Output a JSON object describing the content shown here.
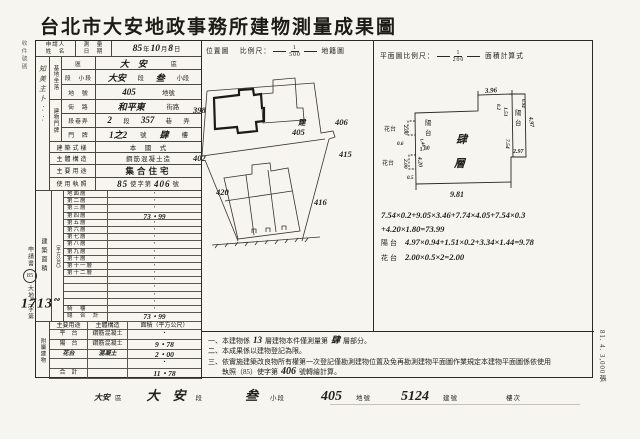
{
  "title": "台北市大安地政事務所建物測量成果圖",
  "margins": {
    "receipt": "收件號碼",
    "stamp_title": "申請書",
    "stamp_year": "85",
    "stamp_doc": "大地二字第",
    "stamp_no": "1713",
    "print_info": "81. 4. 3,000張"
  },
  "header": {
    "applicant1": "申請人",
    "applicant2": "姓　名",
    "hw_marks": "知美主卜︰︰",
    "date_label1": "測　量",
    "date_label2": "日　期",
    "date_y": "85",
    "date_y_u": "年",
    "date_m": "10",
    "date_m_u": "月",
    "date_d": "8",
    "date_d_u": "日",
    "loc_label": "位置圖",
    "loc_scale": "比例尺：",
    "loc_num": "1",
    "loc_den": "500",
    "loc_suffix": "地籍圖",
    "plan_scale": "平面圖比例尺：",
    "plan_num": "1",
    "plan_den": "200",
    "plan_suffix": "面積計算式"
  },
  "site": {
    "group": "基地坐落",
    "r1l": "區",
    "r1v": "大　安",
    "r1u": "區",
    "r2l": "段　小段",
    "r2v1": "大安",
    "r2u1": "段",
    "r2v2": "叁",
    "r2u2": "小段",
    "r3l": "地　號",
    "r3v": "405",
    "r3u": "地號"
  },
  "plate": {
    "group": "建物門牌",
    "r1l": "街　路",
    "r1v": "和平東",
    "r1u": "街路",
    "r2l": "段巷弄",
    "r2v1": "2",
    "r2u1": "段",
    "r2v2": "357",
    "r2u2": "巷",
    "r2u3": "弄",
    "r3l": "門　牌",
    "r3v": "1之2",
    "r3u1": "號",
    "r3v2": "肆",
    "r3u2": "樓"
  },
  "info": {
    "style_l": "建築式樣",
    "style_v": "本　國　式",
    "struct_l": "主體構造",
    "struct_v": "鋼筋混凝土造",
    "use_l": "主要用途",
    "use_v": "集合住宅",
    "lic_l": "使用執照",
    "lic_v1": "85",
    "lic_m": "使字第",
    "lic_v2": "406",
    "lic_u": "號"
  },
  "floors": {
    "group": "建築面積",
    "unit": "（平方公尺）",
    "rows": [
      [
        "地面層",
        "・"
      ],
      [
        "第二層",
        "・"
      ],
      [
        "第三層",
        "・"
      ],
      [
        "第四層",
        "73・99"
      ],
      [
        "第五層",
        "・"
      ],
      [
        "第六層",
        "・"
      ],
      [
        "第七層",
        "・"
      ],
      [
        "第八層",
        "・"
      ],
      [
        "第九層",
        "・"
      ],
      [
        "第十層",
        "・"
      ],
      [
        "第十一層",
        "・"
      ],
      [
        "第十二層",
        "・"
      ],
      [
        "",
        "・"
      ],
      [
        "",
        "・"
      ],
      [
        "",
        "・"
      ],
      [
        "",
        "・"
      ],
      [
        "騎　樓",
        "・"
      ],
      [
        "總　合　計",
        "73・99"
      ]
    ]
  },
  "attached": {
    "group": "附屬建物",
    "h1": "主要用途",
    "h2": "主體構造",
    "h3": "面積（平方公尺）",
    "rows": [
      [
        "平　台",
        "鋼筋混凝土",
        "・"
      ],
      [
        "陽　台",
        "鋼筋混凝土",
        "9・78"
      ],
      [
        "花台",
        "混凝土",
        "2・00"
      ],
      [
        "",
        "",
        "・"
      ],
      [
        "合　計",
        "",
        "11・78"
      ]
    ]
  },
  "map": {
    "p398": "398",
    "p402": "402",
    "p406": "406",
    "p415": "415",
    "p416": "416",
    "p420": "420",
    "subj1": "建",
    "subj2": "405"
  },
  "plan": {
    "d396": "3.96",
    "d151": "1.51",
    "d497": "4.97",
    "d094": "0.94",
    "d02": "0.2",
    "d754": "7.54",
    "d297": "2.97",
    "d981": "9.81",
    "d200a": "2.00",
    "d06": "0.6",
    "d144": "1.44",
    "d180": "1.80",
    "d200b": "2.00",
    "d420": "4.20",
    "d05": "0.5",
    "balc1": "陽",
    "balc2": "台",
    "inbalc1": "陽",
    "inbalc2": "台",
    "flower1": "花台",
    "flower2": "花台",
    "room1": "肆",
    "room2": "層"
  },
  "formulas": {
    "l1": "7.54×0.2+9.05×3.46+7.74×4.05+7.54×0.3",
    "l2": "+4.20×1.80=73.99",
    "l3l": "陽台",
    "l3": "4.97×0.94+1.51×0.2+3.34×1.44=9.78",
    "l4l": "花台",
    "l4": "2.00×0.5×2=2.00"
  },
  "notes": {
    "n1a": "一、本建物係",
    "n1hw": "13",
    "n1b": "層建物本件僅測量第",
    "n1hw2": "肆",
    "n1c": "層部分。",
    "n2": "二、本成果係以建物登記為限。",
    "n3": "三、依實施建築改良物所有權第一次登記僅勘測建物位置及免再勘測建物平面圖作業規定本建物平面圖係依使用",
    "n4a": "　　執照（85）使字第",
    "n4hw": "406",
    "n4b": "號轉繪計算。"
  },
  "footer": {
    "d_hw": "大安",
    "d_u": "區",
    "s_hw": "大　安",
    "s_u": "段",
    "ss_hw": "叁",
    "ss_u": "小段",
    "p_hw": "405",
    "p_u": "地號",
    "b_hw": "5124",
    "b_u": "建號",
    "f_u": "樓次"
  }
}
